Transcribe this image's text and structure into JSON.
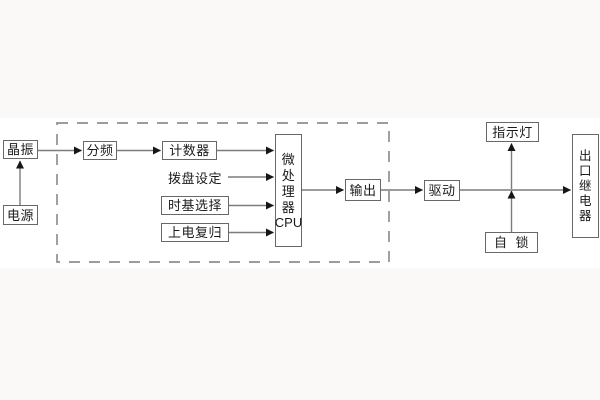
{
  "diagram": {
    "nodes": {
      "crystal": "晶振",
      "power": "电源",
      "divider": "分频",
      "counter": "计数器",
      "dial_setting": "拨盘设定",
      "timebase_select": "时基选择",
      "power_on_reset": "上电复归",
      "mcu_chars": [
        "微",
        "处",
        "理",
        "器"
      ],
      "mcu_cpu": "CPU",
      "output": "输出",
      "drive": "驱动",
      "indicator": "指示灯",
      "self_lock": "自 锁",
      "relay_chars": [
        "出",
        "口",
        "继",
        "电",
        "器"
      ]
    },
    "colors": {
      "background": "#faf9f7",
      "panel": "#ffffff",
      "box_border": "#686868",
      "line": "#7c7c7c",
      "arrowhead": "#161616",
      "dashed_border": "#8f8f8f",
      "text": "#1b1b1b"
    }
  }
}
